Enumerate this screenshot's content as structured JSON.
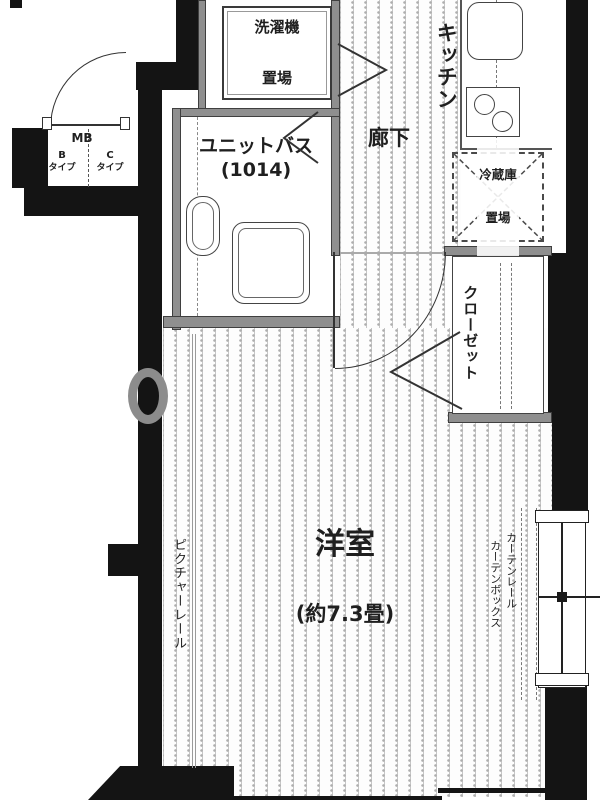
{
  "plan": {
    "title": "apartment-floor-plan",
    "entrance_area": {
      "mb_label": "MB",
      "type_b_letter": "B",
      "type_b_word": "タイプ",
      "type_c_letter": "C",
      "type_c_word": "タイプ"
    },
    "rooms": {
      "laundry": {
        "line1": "洗濯機",
        "line2": "置場"
      },
      "kitchen": {
        "label": "キッチン"
      },
      "hallway": {
        "label": "廊下"
      },
      "bath": {
        "label": "ユニットバス",
        "size": "(1014)"
      },
      "fridge": {
        "line1": "冷蔵庫",
        "line2": "置場"
      },
      "closet": {
        "label": "クローゼット"
      },
      "main_room": {
        "label": "洋室",
        "size": "(約7.3畳)"
      }
    },
    "fixtures": {
      "picture_rail": "ピクチャーレール",
      "curtain_box": "カーテンボックス",
      "curtain_rail": "カーテンレール"
    },
    "colors": {
      "wall": "#141414",
      "partition": "#8f8f8f",
      "floor_line": "#c6c6c6",
      "text": "#1f1f1f"
    }
  }
}
